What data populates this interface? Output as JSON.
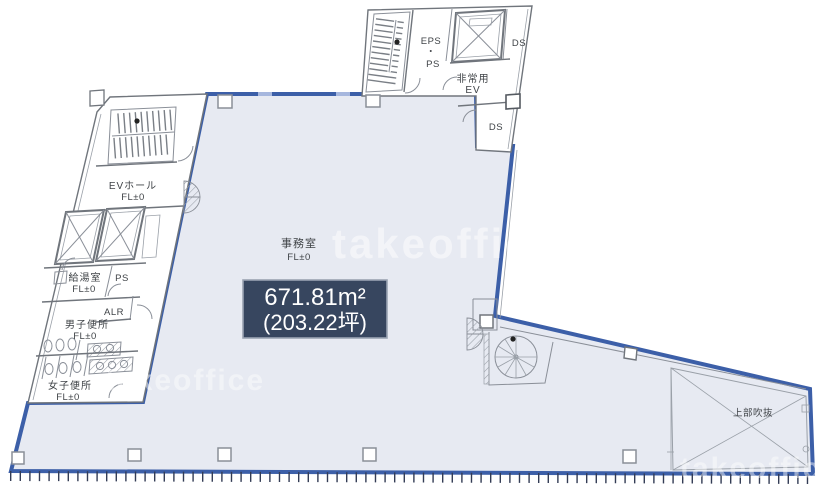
{
  "plan": {
    "watermark": {
      "text": "takeoffice"
    },
    "area_badge": {
      "line1": "671.81m²",
      "line2": "(203.22坪)"
    },
    "labels": {
      "eps": "EPS",
      "eps_dot": "・",
      "ps_top": "PS",
      "ds_top": "DS",
      "emergency_ev_1": "非常用",
      "emergency_ev_2": "EV",
      "ds_mid": "DS",
      "ev_hall_1": "EVホール",
      "ev_hall_2": "FL±0",
      "kitchenette_1": "給湯室",
      "kitchenette_2": "FL±0",
      "ps_side": "PS",
      "alr": "ALR",
      "mens_1": "男子便所",
      "mens_2": "FL±0",
      "womens_1": "女子便所",
      "womens_2": "FL±0",
      "office_1": "事務室",
      "office_2": "FL±0",
      "void": "上部吹抜"
    },
    "colors": {
      "tenant_fill": "#e7eaf2",
      "boundary_blue": "#3c5fa8",
      "badge_fill": "#37465f",
      "badge_border": "#9aa3b2",
      "line_gray": "#8a8f98",
      "text_gray": "#3f4347",
      "tick_dark": "#333c55"
    }
  }
}
